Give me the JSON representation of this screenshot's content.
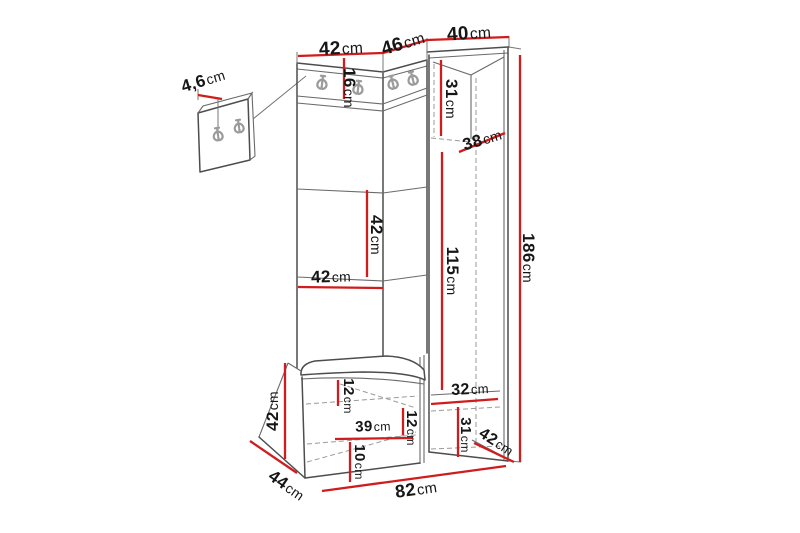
{
  "diagram_title": "Hallway furniture set dimension drawing",
  "dimensions": {
    "top_width_left": {
      "value": "42",
      "unit": "cm"
    },
    "top_width_corner": {
      "value": "46",
      "unit": "cm"
    },
    "top_width_right": {
      "value": "40",
      "unit": "cm"
    },
    "wall_panel_thickness": {
      "value": "4,6",
      "unit": "cm"
    },
    "hook_strip_height": {
      "value": "16",
      "unit": "cm"
    },
    "cabinet_top_niche": {
      "value": "31",
      "unit": "cm"
    },
    "cabinet_depth": {
      "value": "38",
      "unit": "cm"
    },
    "mid_panel_height": {
      "value": "42",
      "unit": "cm"
    },
    "mid_panel_width": {
      "value": "42",
      "unit": "cm"
    },
    "door_height": {
      "value": "115",
      "unit": "cm"
    },
    "total_height": {
      "value": "186",
      "unit": "cm"
    },
    "bench_height": {
      "value": "42",
      "unit": "cm"
    },
    "seat_drawer_height": {
      "value": "12",
      "unit": "cm"
    },
    "drawer_width": {
      "value": "39",
      "unit": "cm"
    },
    "bench_inner_height": {
      "value": "12",
      "unit": "cm"
    },
    "plinth_height": {
      "value": "10",
      "unit": "cm"
    },
    "cabinet_bottom_width": {
      "value": "32",
      "unit": "cm"
    },
    "cabinet_bottom_height": {
      "value": "31",
      "unit": "cm"
    },
    "cabinet_base_depth": {
      "value": "42",
      "unit": "cm"
    },
    "bench_depth": {
      "value": "44",
      "unit": "cm"
    },
    "total_width": {
      "value": "82",
      "unit": "cm"
    }
  }
}
